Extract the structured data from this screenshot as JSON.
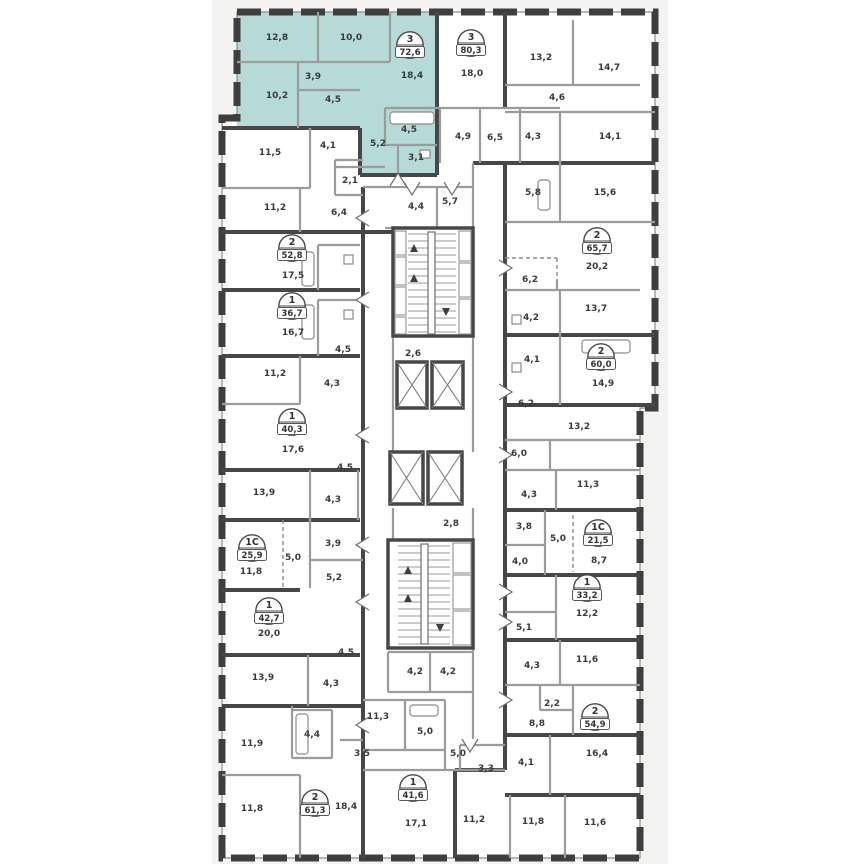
{
  "plan": {
    "colors": {
      "canvas": "#f3f3f1",
      "wall": "#3e3e3e",
      "partition": "#9b9b9b",
      "highlight": "#b5dad7",
      "text": "#3a3a3a"
    },
    "highlighted_apartment": {
      "type": "3",
      "area": "72,6"
    },
    "badges": [
      {
        "type": "3",
        "area": "72,6",
        "x": 410,
        "y": 45,
        "highlighted": true
      },
      {
        "type": "3",
        "area": "80,3",
        "x": 471,
        "y": 43
      },
      {
        "type": "2",
        "area": "52,8",
        "x": 292,
        "y": 248
      },
      {
        "type": "1",
        "area": "36,7",
        "x": 292,
        "y": 306
      },
      {
        "type": "1",
        "area": "40,3",
        "x": 292,
        "y": 422
      },
      {
        "type": "1C",
        "area": "25,9",
        "x": 252,
        "y": 548
      },
      {
        "type": "1",
        "area": "42,7",
        "x": 269,
        "y": 611
      },
      {
        "type": "2",
        "area": "61,3",
        "x": 315,
        "y": 803
      },
      {
        "type": "1",
        "area": "41,6",
        "x": 413,
        "y": 788
      },
      {
        "type": "2",
        "area": "65,7",
        "x": 597,
        "y": 241
      },
      {
        "type": "2",
        "area": "60,0",
        "x": 601,
        "y": 357
      },
      {
        "type": "1C",
        "area": "21,5",
        "x": 598,
        "y": 533
      },
      {
        "type": "1",
        "area": "33,2",
        "x": 587,
        "y": 588
      },
      {
        "type": "2",
        "area": "54,9",
        "x": 595,
        "y": 717
      }
    ],
    "rooms": [
      {
        "label": "12,8",
        "x": 277,
        "y": 40
      },
      {
        "label": "10,0",
        "x": 351,
        "y": 40
      },
      {
        "label": "3,9",
        "x": 313,
        "y": 79
      },
      {
        "label": "18,4",
        "x": 412,
        "y": 78
      },
      {
        "label": "10,2",
        "x": 277,
        "y": 98
      },
      {
        "label": "4,5",
        "x": 333,
        "y": 102
      },
      {
        "label": "4,5",
        "x": 409,
        "y": 132
      },
      {
        "label": "5,2",
        "x": 378,
        "y": 146
      },
      {
        "label": "3,1",
        "x": 416,
        "y": 160
      },
      {
        "label": "18,0",
        "x": 472,
        "y": 76
      },
      {
        "label": "13,2",
        "x": 541,
        "y": 60
      },
      {
        "label": "14,7",
        "x": 609,
        "y": 70
      },
      {
        "label": "4,6",
        "x": 557,
        "y": 100
      },
      {
        "label": "4,9",
        "x": 463,
        "y": 139
      },
      {
        "label": "6,5",
        "x": 495,
        "y": 140
      },
      {
        "label": "4,3",
        "x": 533,
        "y": 139
      },
      {
        "label": "14,1",
        "x": 610,
        "y": 139
      },
      {
        "label": "11,5",
        "x": 270,
        "y": 155
      },
      {
        "label": "4,1",
        "x": 328,
        "y": 148
      },
      {
        "label": "2,1",
        "x": 350,
        "y": 183
      },
      {
        "label": "11,2",
        "x": 275,
        "y": 210
      },
      {
        "label": "6,4",
        "x": 339,
        "y": 215
      },
      {
        "label": "17,5",
        "x": 293,
        "y": 278
      },
      {
        "label": "16,7",
        "x": 293,
        "y": 335
      },
      {
        "label": "4,5",
        "x": 343,
        "y": 352
      },
      {
        "label": "11,2",
        "x": 275,
        "y": 376
      },
      {
        "label": "4,3",
        "x": 332,
        "y": 386
      },
      {
        "label": "17,6",
        "x": 293,
        "y": 452
      },
      {
        "label": "4,5",
        "x": 345,
        "y": 470
      },
      {
        "label": "13,9",
        "x": 264,
        "y": 495
      },
      {
        "label": "4,3",
        "x": 333,
        "y": 502
      },
      {
        "label": "3,9",
        "x": 333,
        "y": 546
      },
      {
        "label": "5,0",
        "x": 293,
        "y": 560
      },
      {
        "label": "11,8",
        "x": 251,
        "y": 574
      },
      {
        "label": "5,2",
        "x": 334,
        "y": 580
      },
      {
        "label": "20,0",
        "x": 269,
        "y": 636
      },
      {
        "label": "4,5",
        "x": 346,
        "y": 655
      },
      {
        "label": "13,9",
        "x": 263,
        "y": 680
      },
      {
        "label": "4,3",
        "x": 331,
        "y": 686
      },
      {
        "label": "11,9",
        "x": 252,
        "y": 746
      },
      {
        "label": "4,4",
        "x": 312,
        "y": 737
      },
      {
        "label": "11,8",
        "x": 252,
        "y": 811
      },
      {
        "label": "18,4",
        "x": 346,
        "y": 809
      },
      {
        "label": "4,4",
        "x": 416,
        "y": 209
      },
      {
        "label": "5,7",
        "x": 450,
        "y": 204
      },
      {
        "label": "2,6",
        "x": 413,
        "y": 356
      },
      {
        "label": "2,8",
        "x": 451,
        "y": 526
      },
      {
        "label": "4,2",
        "x": 415,
        "y": 674
      },
      {
        "label": "4,2",
        "x": 448,
        "y": 674
      },
      {
        "label": "11,3",
        "x": 378,
        "y": 719
      },
      {
        "label": "5,0",
        "x": 425,
        "y": 734
      },
      {
        "label": "3,5",
        "x": 362,
        "y": 756
      },
      {
        "label": "5,0",
        "x": 458,
        "y": 756
      },
      {
        "label": "3,3",
        "x": 486,
        "y": 771
      },
      {
        "label": "17,1",
        "x": 416,
        "y": 826
      },
      {
        "label": "11,2",
        "x": 474,
        "y": 822
      },
      {
        "label": "5,8",
        "x": 533,
        "y": 195
      },
      {
        "label": "15,6",
        "x": 605,
        "y": 195
      },
      {
        "label": "20,2",
        "x": 597,
        "y": 269
      },
      {
        "label": "6,2",
        "x": 530,
        "y": 282
      },
      {
        "label": "13,7",
        "x": 596,
        "y": 311
      },
      {
        "label": "4,2",
        "x": 531,
        "y": 320
      },
      {
        "label": "4,1",
        "x": 532,
        "y": 362
      },
      {
        "label": "14,9",
        "x": 603,
        "y": 386
      },
      {
        "label": "6,2",
        "x": 526,
        "y": 406
      },
      {
        "label": "13,2",
        "x": 579,
        "y": 429
      },
      {
        "label": "6,0",
        "x": 519,
        "y": 456
      },
      {
        "label": "11,3",
        "x": 588,
        "y": 487
      },
      {
        "label": "4,3",
        "x": 529,
        "y": 497
      },
      {
        "label": "3,8",
        "x": 524,
        "y": 529
      },
      {
        "label": "5,0",
        "x": 558,
        "y": 541
      },
      {
        "label": "8,7",
        "x": 599,
        "y": 563
      },
      {
        "label": "4,0",
        "x": 520,
        "y": 564
      },
      {
        "label": "12,2",
        "x": 587,
        "y": 616
      },
      {
        "label": "5,1",
        "x": 524,
        "y": 630
      },
      {
        "label": "11,6",
        "x": 587,
        "y": 662
      },
      {
        "label": "4,3",
        "x": 532,
        "y": 668
      },
      {
        "label": "2,2",
        "x": 552,
        "y": 706
      },
      {
        "label": "8,8",
        "x": 537,
        "y": 726
      },
      {
        "label": "16,4",
        "x": 597,
        "y": 756
      },
      {
        "label": "4,1",
        "x": 526,
        "y": 765
      },
      {
        "label": "11,8",
        "x": 533,
        "y": 824
      },
      {
        "label": "11,6",
        "x": 595,
        "y": 825
      }
    ]
  }
}
